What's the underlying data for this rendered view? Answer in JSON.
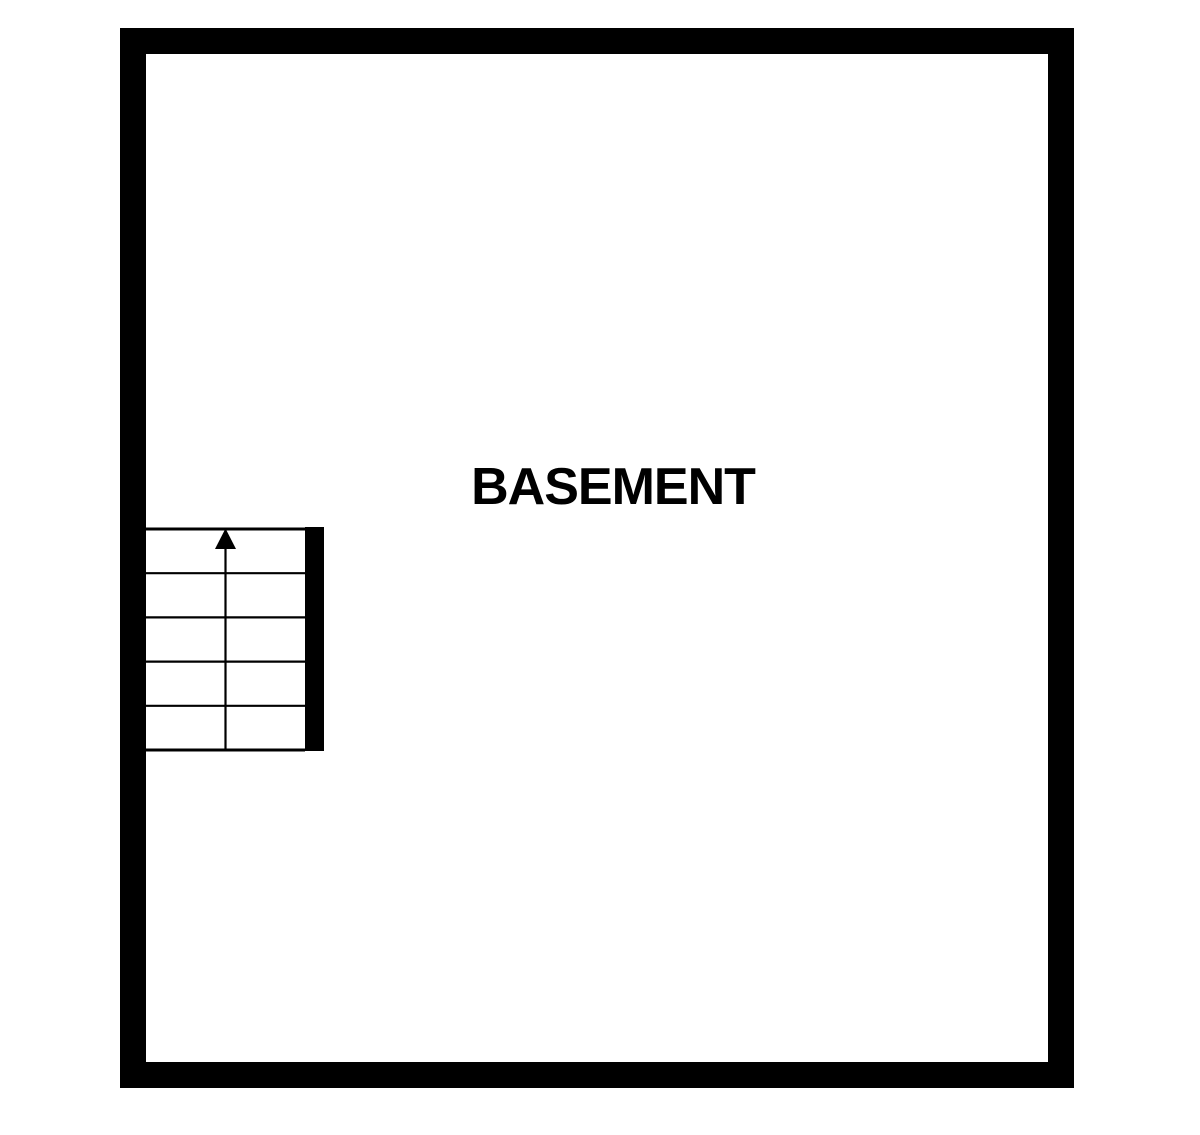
{
  "floorplan": {
    "room_label": "BASEMENT",
    "colors": {
      "wall": "#000000",
      "floor": "#ffffff",
      "line": "#000000"
    },
    "staircase": {
      "treads": 5,
      "direction": "up",
      "icon": "up-arrow-icon"
    }
  }
}
